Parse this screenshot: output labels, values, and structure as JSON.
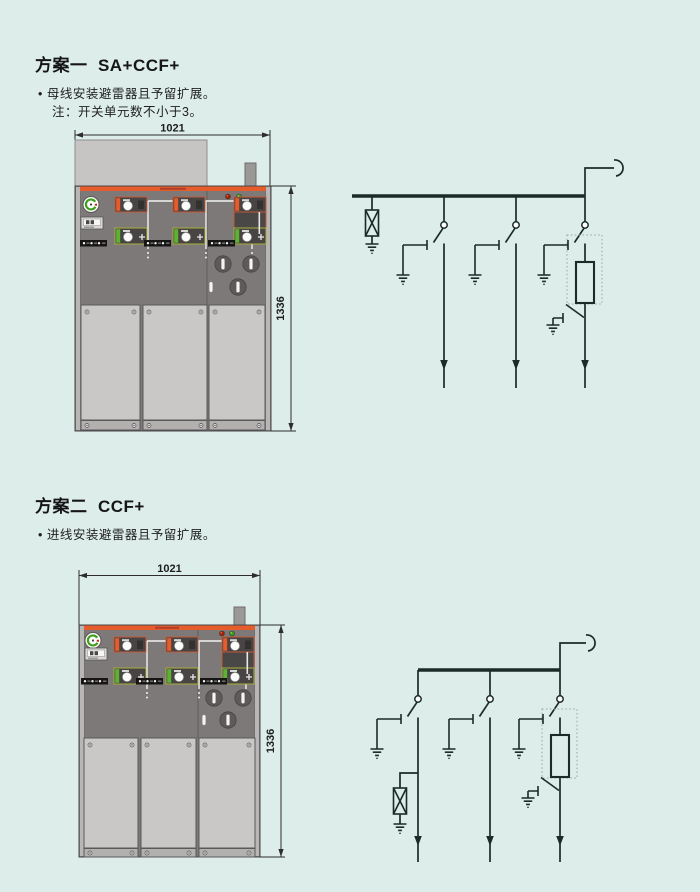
{
  "page": {
    "background_color": "#dcedea"
  },
  "colors": {
    "accent_orange": "#e75c2b",
    "module_green": "#5cb233",
    "led_red": "#b01e00",
    "led_green": "#3da019",
    "cabinet_gray": "#7c7978",
    "panel_light_gray": "#c9c8c7",
    "diagram_line": "#1c2b26"
  },
  "scheme1": {
    "title": "方案一  SA+CCF+",
    "notes": [
      "• 母线安装避雷器且予留扩展。",
      "注：开关单元数不小于3。"
    ],
    "cabinet": {
      "width_label": "1021",
      "height_label": "1336"
    },
    "diagram": {
      "symbols": [
        "busbar",
        "surge-arrester",
        "load-break-switch",
        "earthing-switch",
        "fuse",
        "cable-feeder-arrow",
        "incoming-line-hook"
      ]
    }
  },
  "scheme2": {
    "title": "方案二  CCF+",
    "notes": [
      "• 进线安装避雷器且予留扩展。"
    ],
    "cabinet": {
      "width_label": "1021",
      "height_label": "1336"
    },
    "diagram": {
      "symbols": [
        "busbar",
        "surge-arrester",
        "load-break-switch",
        "earthing-switch",
        "fuse",
        "cable-feeder-arrow",
        "incoming-line-hook"
      ]
    }
  }
}
